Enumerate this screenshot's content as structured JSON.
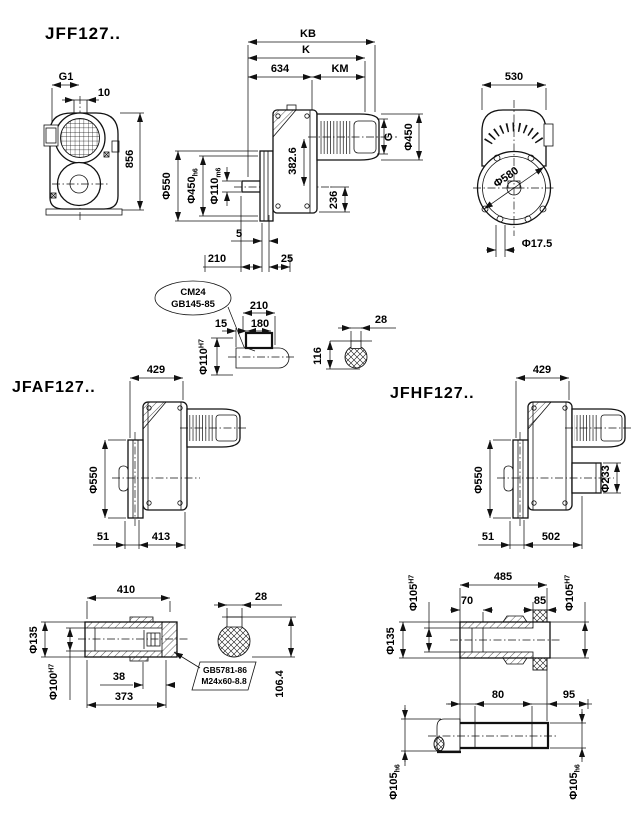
{
  "jff": {
    "title": "JFF127..",
    "front": {
      "g1": "G1",
      "w10": "10",
      "h856": "856"
    },
    "side": {
      "kb": "KB",
      "k": "K",
      "l634": "634",
      "km": "KM",
      "dia550": "Φ550",
      "dia450": "Φ450",
      "dia450_tol": "h6",
      "dia110": "Φ110",
      "dia110_tol": "m6",
      "h382": "382.6",
      "h236": "236",
      "g": "G",
      "dia450m": "Φ450",
      "off5": "5",
      "l210": "210",
      "l25": "25"
    },
    "rear": {
      "w530": "530",
      "dia580": "Φ580",
      "dia17": "Φ17.5"
    }
  },
  "detail": {
    "balloon1": "CM24",
    "balloon2": "GB145-85",
    "l210": "210",
    "l180": "180",
    "l15": "15",
    "dia110": "Φ110",
    "dia110_tol": "H7",
    "h116": "116",
    "w28": "28"
  },
  "jfaf": {
    "title": "JFAF127..",
    "w429": "429",
    "dia550": "Φ550",
    "l51": "51",
    "l413": "413"
  },
  "jfhf": {
    "title": "JFHF127..",
    "w429": "429",
    "dia550": "Φ550",
    "dia233": "Φ233",
    "l51": "51",
    "l502": "502"
  },
  "shaft_f": {
    "l410": "410",
    "dia135": "Φ135",
    "dia100": "Φ100",
    "dia100_tol": "H7",
    "l38": "38",
    "l373": "373",
    "balloon1": "GB5781-86",
    "balloon2": "M24x60-8.8",
    "w28": "28",
    "h106": "106.4"
  },
  "shaft_h": {
    "l485": "485",
    "l70": "70",
    "l85": "85",
    "dia105a": "Φ105",
    "dia105a_tol": "H7",
    "dia105b": "Φ105",
    "dia105b_tol": "H7",
    "dia135": "Φ135",
    "l80": "80",
    "l95": "95",
    "dia105c": "Φ105",
    "dia105c_tol": "h6",
    "dia105d": "Φ105",
    "dia105d_tol": "h6"
  }
}
